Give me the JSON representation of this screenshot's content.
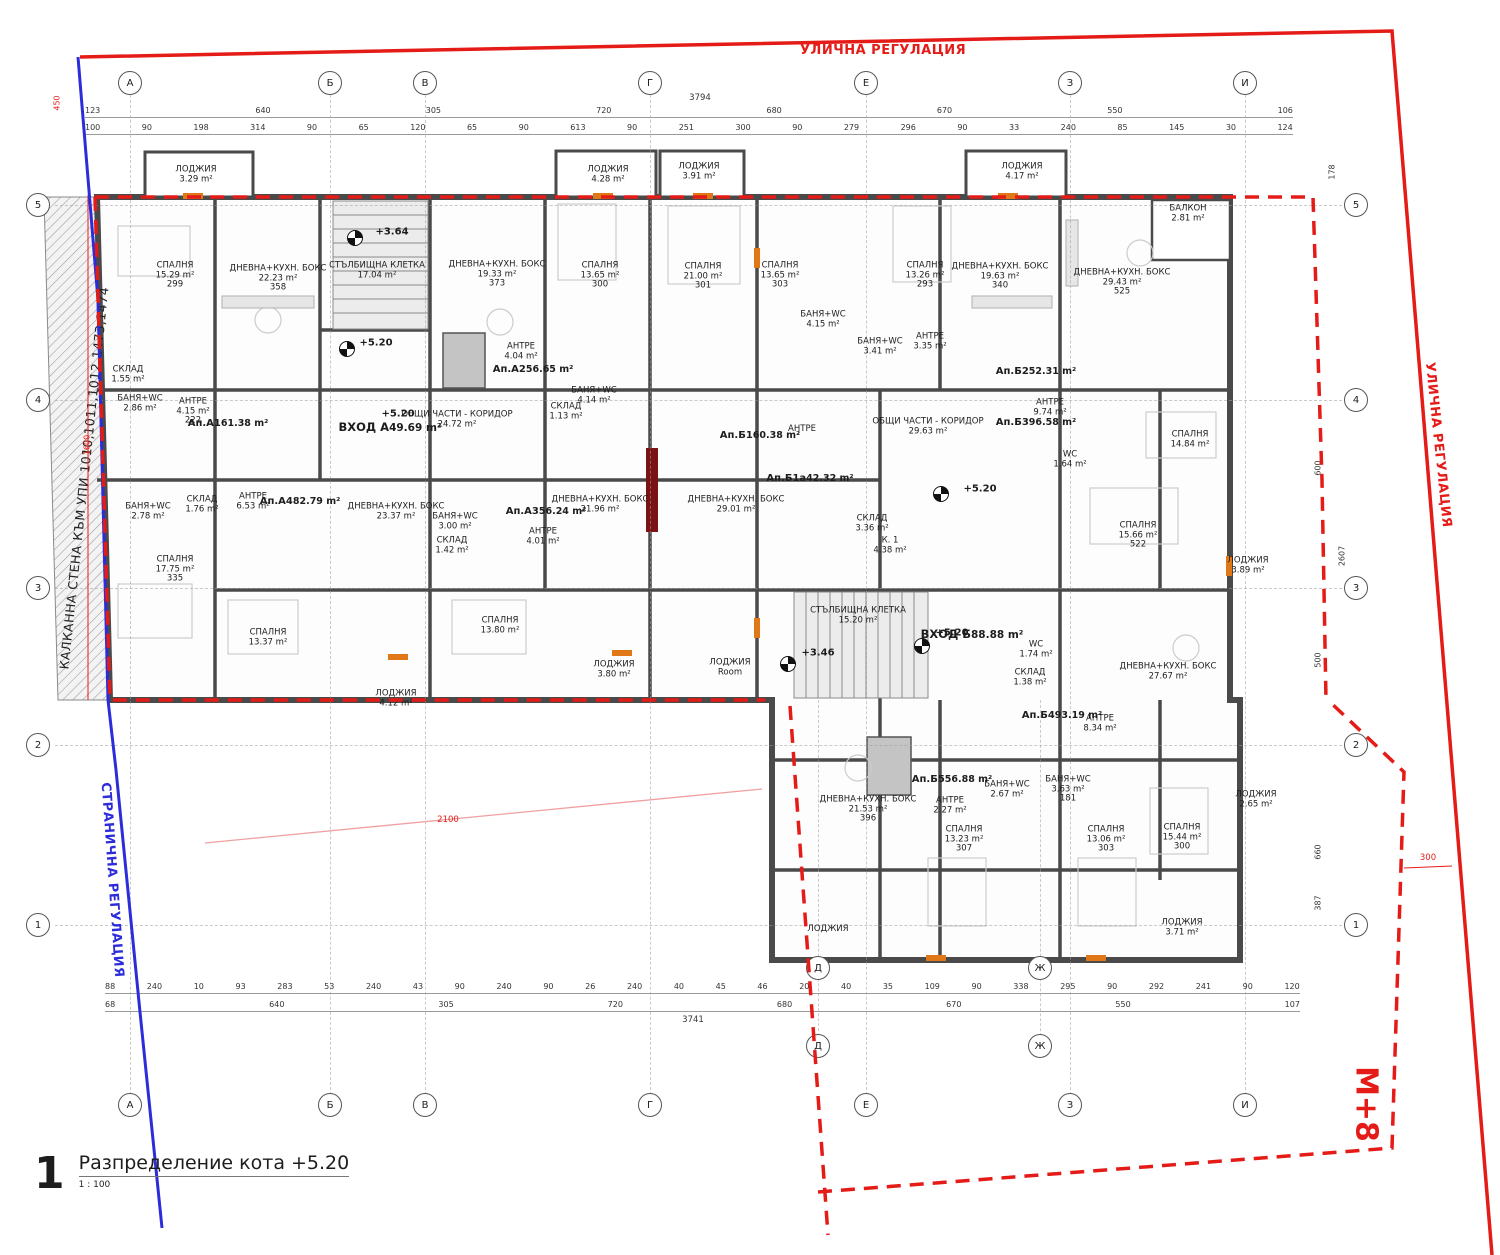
{
  "colors": {
    "regulation_red": "#e51b18",
    "boundary_blue": "#2c2cdb",
    "wall_gray": "#4a4a4a",
    "pink_line": "#f0a0a0",
    "marker_orange": "#e07818",
    "section_bar_dark_red": "#7a1414"
  },
  "title_block": {
    "number": "1",
    "title": "Разпределение кота +5.20",
    "scale": "1 : 100"
  },
  "boundaries": {
    "street_top": "УЛИЧНА РЕГУЛАЦИЯ",
    "street_right": "УЛИЧНА РЕГУЛАЦИЯ",
    "side": "СТРАНИЧНА РЕГУЛАЦИЯ",
    "party_wall": "КАЛКАННА СТЕНА КЪМ УПИ 1010,1011,1012,1473,1474",
    "zone": "М+8"
  },
  "axes": {
    "columns": [
      {
        "label": "А",
        "x": 130
      },
      {
        "label": "Б",
        "x": 330
      },
      {
        "label": "В",
        "x": 425
      },
      {
        "label": "Г",
        "x": 650
      },
      {
        "label": "Е",
        "x": 866
      },
      {
        "label": "З",
        "x": 1070
      },
      {
        "label": "И",
        "x": 1245
      }
    ],
    "rows": [
      {
        "label": "5",
        "y": 205
      },
      {
        "label": "4",
        "y": 400
      },
      {
        "label": "3",
        "y": 588
      },
      {
        "label": "2",
        "y": 745
      },
      {
        "label": "1",
        "y": 925
      }
    ],
    "wing": [
      {
        "label": "Д",
        "x": 818
      },
      {
        "label": "Ж",
        "x": 1040
      }
    ]
  },
  "dimensions": {
    "top_overall": "3794",
    "bottom_overall": "3741",
    "top_row1": [
      "123",
      "640",
      "305",
      "720",
      "680",
      "670",
      "550",
      "106"
    ],
    "top_row2": [
      "100",
      "90",
      "198",
      "314",
      "90",
      "65",
      "120",
      "65",
      "90",
      "613",
      "90",
      "251",
      "300",
      "90",
      "279",
      "296",
      "90",
      "33",
      "240",
      "85",
      "145",
      "30",
      "124"
    ],
    "bottom_row1": [
      "88",
      "240",
      "10",
      "93",
      "283",
      "53",
      "240",
      "43",
      "90",
      "240",
      "90",
      "26",
      "240",
      "40",
      "45",
      "46",
      "20",
      "40",
      "35",
      "109",
      "90",
      "338",
      "295",
      "90",
      "292",
      "241",
      "90",
      "120"
    ],
    "bottom_row2": [
      "68",
      "640",
      "305",
      "720",
      "680",
      "670",
      "550",
      "107"
    ],
    "right_side": [
      {
        "v": "178",
        "x": 1332,
        "y": 172
      },
      {
        "v": "600",
        "x": 1318,
        "y": 468
      },
      {
        "v": "2607",
        "x": 1342,
        "y": 556
      },
      {
        "v": "500",
        "x": 1318,
        "y": 660
      },
      {
        "v": "660",
        "x": 1318,
        "y": 852
      },
      {
        "v": "387",
        "x": 1318,
        "y": 903
      }
    ],
    "left_side": [
      {
        "v": "450",
        "x": 57,
        "y": 103
      },
      {
        "v": "1600",
        "x": 87,
        "y": 445
      }
    ],
    "setback_right": "300",
    "setback_side": "2100"
  },
  "levels": [
    {
      "v": "+3.64",
      "x": 392,
      "y": 232
    },
    {
      "v": "+5.20",
      "x": 376,
      "y": 343
    },
    {
      "v": "+5.20",
      "x": 398,
      "y": 414
    },
    {
      "v": "+5.20",
      "x": 980,
      "y": 489
    },
    {
      "v": "+5.20",
      "x": 952,
      "y": 633
    },
    {
      "v": "+3.46",
      "x": 818,
      "y": 653
    }
  ],
  "north_markers": [
    {
      "x": 355,
      "y": 238
    },
    {
      "x": 347,
      "y": 349
    },
    {
      "x": 941,
      "y": 494
    },
    {
      "x": 922,
      "y": 646
    },
    {
      "x": 788,
      "y": 664
    }
  ],
  "rooms": [
    {
      "name": "СПАЛНЯ",
      "area": "15.29 m²",
      "sub": "299",
      "x": 175,
      "y": 276
    },
    {
      "name": "ДНЕВНА+КУХН. БОКС",
      "area": "22.23 m²",
      "sub": "358",
      "x": 278,
      "y": 279
    },
    {
      "name": "СТЪЛБИЩНА КЛЕТКА",
      "area": "17.04 m²",
      "x": 377,
      "y": 271
    },
    {
      "name": "ДНЕВНА+КУХН. БОКС",
      "area": "19.33 m²",
      "sub": "373",
      "x": 497,
      "y": 275
    },
    {
      "name": "СПАЛНЯ",
      "area": "13.65 m²",
      "sub": "300",
      "x": 600,
      "y": 276
    },
    {
      "name": "СПАЛНЯ",
      "area": "21.00 m²",
      "sub": "301",
      "x": 703,
      "y": 277
    },
    {
      "name": "СПАЛНЯ",
      "area": "13.65 m²",
      "sub": "303",
      "x": 780,
      "y": 276
    },
    {
      "name": "СПАЛНЯ",
      "area": "13.26 m²",
      "sub": "293",
      "x": 925,
      "y": 276
    },
    {
      "name": "ДНЕВНА+КУХН. БОКС",
      "area": "19.63 m²",
      "sub": "340",
      "x": 1000,
      "y": 277
    },
    {
      "name": "ДНЕВНА+КУХН. БОКС",
      "area": "29.43 m²",
      "sub": "525",
      "x": 1122,
      "y": 283
    },
    {
      "name": "БАЛКОН",
      "area": "2.81 m²",
      "x": 1188,
      "y": 214
    },
    {
      "name": "ЛОДЖИЯ",
      "area": "3.29 m²",
      "x": 196,
      "y": 175
    },
    {
      "name": "ЛОДЖИЯ",
      "area": "4.28 m²",
      "x": 608,
      "y": 175
    },
    {
      "name": "ЛОДЖИЯ",
      "area": "3.91 m²",
      "x": 699,
      "y": 172
    },
    {
      "name": "ЛОДЖИЯ",
      "area": "4.17 m²",
      "x": 1022,
      "y": 172
    },
    {
      "name": "БАНЯ+WC",
      "area": "4.15 m²",
      "x": 823,
      "y": 320
    },
    {
      "name": "БАНЯ+WC",
      "area": "3.41 m²",
      "x": 880,
      "y": 347
    },
    {
      "name": "АНТРЕ",
      "area": "3.35 m²",
      "x": 930,
      "y": 342
    },
    {
      "name": "АНТРЕ",
      "area": "4.15 m²",
      "sub": "222",
      "x": 193,
      "y": 412
    },
    {
      "name": "БАНЯ+WC",
      "area": "2.86 m²",
      "x": 140,
      "y": 404
    },
    {
      "name": "СКЛАД",
      "area": "1.55 m²",
      "x": 128,
      "y": 375
    },
    {
      "name": "СКЛАД",
      "area": "1.76 m²",
      "x": 202,
      "y": 505
    },
    {
      "name": "БАНЯ+WC",
      "area": "2.78 m²",
      "x": 148,
      "y": 512
    },
    {
      "name": "АНТРЕ",
      "area": "6.53 m²",
      "x": 253,
      "y": 502
    },
    {
      "name": "СПАЛНЯ",
      "area": "17.75 m²",
      "sub": "335",
      "x": 175,
      "y": 570
    },
    {
      "name": "ДНЕВНА+КУХН. БОКС",
      "area": "23.37 m²",
      "x": 396,
      "y": 512
    },
    {
      "name": "БАНЯ+WC",
      "area": "3.00 m²",
      "x": 455,
      "y": 522
    },
    {
      "name": "СКЛАД",
      "area": "1.42 m²",
      "x": 452,
      "y": 546
    },
    {
      "name": "АНТРЕ",
      "area": "4.01 m²",
      "x": 543,
      "y": 537
    },
    {
      "name": "ДНЕВНА+КУХН. БОКС",
      "area": "21.96 m²",
      "x": 600,
      "y": 505
    },
    {
      "name": "ОБЩИ ЧАСТИ - КОРИДОР",
      "area": "24.72 m²",
      "x": 457,
      "y": 420
    },
    {
      "name": "АНТРЕ",
      "area": "4.04 m²",
      "x": 521,
      "y": 352
    },
    {
      "name": "БАНЯ+WC",
      "area": "4.14 m²",
      "x": 594,
      "y": 396
    },
    {
      "name": "СКЛАД",
      "area": "1.13 m²",
      "x": 566,
      "y": 412
    },
    {
      "name": "Ап.А1",
      "area": "61.38 m²",
      "kind": "apt",
      "x": 228,
      "y": 424
    },
    {
      "name": "Ап.А2",
      "area": "56.65 m²",
      "kind": "apt",
      "x": 533,
      "y": 370
    },
    {
      "name": "Ап.А3",
      "area": "56.24 m²",
      "kind": "apt",
      "x": 546,
      "y": 512
    },
    {
      "name": "Ап.А4",
      "area": "82.79 m²",
      "kind": "apt",
      "x": 300,
      "y": 502
    },
    {
      "name": "ВХОД А",
      "area": "49.69 m²",
      "kind": "entry",
      "x": 390,
      "y": 428
    },
    {
      "name": "Ап.Б1",
      "area": "60.38 m²",
      "kind": "apt",
      "x": 760,
      "y": 436
    },
    {
      "name": "АНТРЕ",
      "x": 802,
      "y": 430
    },
    {
      "name": "ОБЩИ ЧАСТИ - КОРИДОР",
      "area": "29.63 m²",
      "x": 928,
      "y": 427
    },
    {
      "name": "Ап.Б1а",
      "area": "42.32 m²",
      "kind": "apt",
      "x": 810,
      "y": 479
    },
    {
      "name": "СКЛАД",
      "area": "3.36 m²",
      "x": 872,
      "y": 524
    },
    {
      "name": "К. 1",
      "area": "4.38 m²",
      "x": 890,
      "y": 546
    },
    {
      "name": "ДНЕВНА+КУХН. БОКС",
      "area": "29.01 m²",
      "x": 736,
      "y": 505
    },
    {
      "name": "Ап.Б2",
      "area": "52.31 m²",
      "kind": "apt",
      "x": 1036,
      "y": 372
    },
    {
      "name": "АНТРЕ",
      "area": "9.74 m²",
      "x": 1050,
      "y": 408
    },
    {
      "name": "Ап.Б3",
      "area": "96.58 m²",
      "kind": "apt",
      "x": 1036,
      "y": 423
    },
    {
      "name": "WC",
      "area": "1.64 m²",
      "x": 1070,
      "y": 460
    },
    {
      "name": "СПАЛНЯ",
      "area": "14.84 m²",
      "x": 1190,
      "y": 440
    },
    {
      "name": "СПАЛНЯ",
      "area": "15.66 m²",
      "sub": "522",
      "x": 1138,
      "y": 536
    },
    {
      "name": "ЛОДЖИЯ",
      "area": "3.89 m²",
      "x": 1248,
      "y": 566
    },
    {
      "name": "СПАЛНЯ",
      "area": "13.37 m²",
      "x": 268,
      "y": 638
    },
    {
      "name": "ЛОДЖИЯ",
      "area": "4.12 m²",
      "x": 396,
      "y": 699
    },
    {
      "name": "СПАЛНЯ",
      "area": "13.80 m²",
      "x": 500,
      "y": 626
    },
    {
      "name": "ЛОДЖИЯ",
      "area": "3.80 m²",
      "x": 614,
      "y": 670
    },
    {
      "name": "ЛОДЖИЯ",
      "area": "Room",
      "x": 730,
      "y": 668
    },
    {
      "name": "СТЪЛБИЩНА КЛЕТКА",
      "area": "15.20 m²",
      "x": 858,
      "y": 616
    },
    {
      "name": "ВХОД Б",
      "area": "88.88 m²",
      "kind": "entry",
      "x": 972,
      "y": 635
    },
    {
      "name": "WC",
      "area": "1.74 m²",
      "x": 1036,
      "y": 650
    },
    {
      "name": "СКЛАД",
      "area": "1.38 m²",
      "x": 1030,
      "y": 678
    },
    {
      "name": "Ап.Б4",
      "area": "93.19 m²",
      "kind": "apt",
      "x": 1062,
      "y": 716
    },
    {
      "name": "АНТРЕ",
      "area": "8.34 m²",
      "x": 1100,
      "y": 724
    },
    {
      "name": "ДНЕВНА+КУХН. БОКС",
      "area": "27.67 m²",
      "x": 1168,
      "y": 672
    },
    {
      "name": "ЛОДЖИЯ",
      "area": "2.65 m²",
      "x": 1256,
      "y": 800
    },
    {
      "name": "Ап.Б5",
      "area": "56.88 m²",
      "kind": "apt",
      "x": 952,
      "y": 780
    },
    {
      "name": "АНТРЕ",
      "area": "2.27 m²",
      "x": 950,
      "y": 806
    },
    {
      "name": "БАНЯ+WC",
      "area": "2.67 m²",
      "x": 1007,
      "y": 790
    },
    {
      "name": "БАНЯ+WC",
      "area": "3.63 m²",
      "sub": "181",
      "x": 1068,
      "y": 790
    },
    {
      "name": "ДНЕВНА+КУХН. БОКС",
      "area": "21.53 m²",
      "sub": "396",
      "x": 868,
      "y": 810
    },
    {
      "name": "СПАЛНЯ",
      "area": "13.23 m²",
      "sub": "307",
      "x": 964,
      "y": 840
    },
    {
      "name": "СПАЛНЯ",
      "area": "13.06 m²",
      "sub": "303",
      "x": 1106,
      "y": 840
    },
    {
      "name": "СПАЛНЯ",
      "area": "15.44 m²",
      "sub": "300",
      "x": 1182,
      "y": 838
    },
    {
      "name": "ЛОДЖИЯ",
      "x": 828,
      "y": 930
    },
    {
      "name": "ЛОДЖИЯ",
      "area": "3.71 m²",
      "x": 1182,
      "y": 928
    }
  ]
}
